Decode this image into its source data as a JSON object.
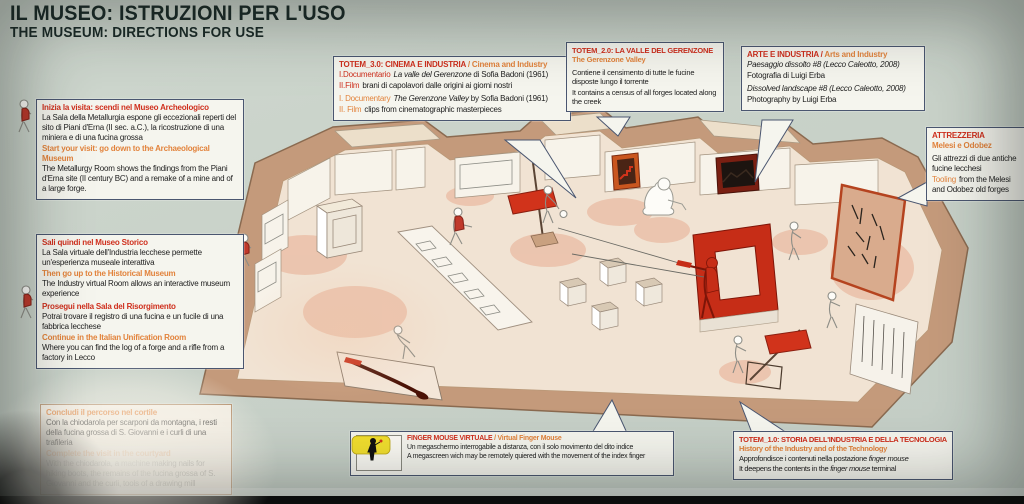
{
  "title": {
    "it": "IL MUSEO: ISTRUZIONI PER L'USO",
    "en": "THE MUSEUM: DIRECTIONS FOR USE"
  },
  "colors": {
    "accent_red": "#cf2f1d",
    "accent_orange": "#e2833c",
    "box_border": "#4a5670",
    "panel_background": "#c9d2c9",
    "room_wall": "#c9a180",
    "room_floor": "#f1e3d3",
    "highlight_salmon": "#e7ad92",
    "megascreen_red": "#c62d17",
    "finger_icon_yellow": "#f2df2e"
  },
  "boxes": {
    "archeo": {
      "h_it": "Inizia la visita: scendi nel Museo Archeologico",
      "b_it": "La Sala della Metallurgia espone gli eccezionali reperti del sito di Piani d'Erna (II sec. a.C.), la ricostruzione di una miniera e di una fucina grossa",
      "h_en": "Start your visit: go down to the Archaeological Museum",
      "b_en": "The Metallurgy Room shows the findings from the Piani d'Erna site (II century BC) and a remake of a mine and of a large forge."
    },
    "storico": {
      "h1_it": "Sali quindi nel Museo Storico",
      "b1_it": "La Sala virtuale dell'Industria lecchese permette un'esperienza museale interattiva",
      "h1_en": "Then go up to the Historical Museum",
      "b1_en": "The Industry virtual Room allows an interactive museum experience",
      "h2_it": "Prosegui nella Sala del Risorgimento",
      "b2_it": "Potrai trovare il registro di una fucina e un fucile di una fabbrica lecchese",
      "h2_en": "Continue in the Italian Unification Room",
      "b2_en": "Where you can find the log of a forge and a rifle from a factory in Lecco"
    },
    "cortile": {
      "h_it": "Concludi il percorso nel cortile",
      "b_it": "Con la chiodarola per scarponi da montagna, i resti della fucina grossa di S. Giovanni e i curli di una trafileria",
      "h_en": "Complete the visit in the courtyard",
      "b_en": "With the chiodarola, a machine making nails for hiking boots, the remains of the fucina grossa of S. Giovanni and the curli, tools of a drawing mill"
    },
    "totem3": {
      "h_it": "TOTEM_3.0: CINEMA E INDUSTRIA",
      "h_en": "/ Cinema and Industry",
      "l1_label": "I.Documentario",
      "l1_title": "La valle del Gerenzone",
      "l1_rest": "di Sofia Badoni (1961)",
      "l2_label": "II.Film",
      "l2_rest": "brani di capolavori dalle origini ai giorni nostri",
      "l3_label": "I. Documentary",
      "l3_title": "The Gerenzone Valley",
      "l3_rest": "by Sofia Badoni (1961)",
      "l4_label": "II. Film",
      "l4_rest": "clips from cinematographic masterpieces"
    },
    "totem2": {
      "h_it": "TOTEM_2.0: LA VALLE DEL GERENZONE",
      "h_en": "The Gerenzone Valley",
      "b_it": "Contiene il censimento di tutte le fucine disposte lungo il torrente",
      "b_en": "It contains a census of all forges located along the creek"
    },
    "arte": {
      "h_it": "ARTE E INDUSTRIA /",
      "h_en": "Arts and Industry",
      "work_it": "Paesaggio dissolto #8 (Lecco Caleotto, 2008)",
      "credit_it": "Fotografia di Luigi Erba",
      "work_en": "Dissolved landscape #8 (Lecco Caleotto, 2008)",
      "credit_en": "Photography by Luigi Erba"
    },
    "attrezzeria": {
      "h": "ATTREZZERIA",
      "sub": "Melesi e Odobez",
      "b_it": "Gli attrezzi di due antiche fucine lecchesi",
      "b_en_label": "Tooling",
      "b_en_rest": "from the Melesi and Odobez old forges"
    },
    "finger": {
      "h_it": "FINGER MOUSE VIRTUALE",
      "h_en": "/ Virtual Finger Mouse",
      "b_it": "Un megaschermo interrogabile a distanza, con il solo movimento del dito indice",
      "b_en": "A megascreen wich may be remotely quiered with the movement of the index finger"
    },
    "totem1": {
      "h_it": "TOTEM_1.0: STORIA DELL'INDUSTRIA E DELLA TECNOLOGIA",
      "h_en": "History of the Industry and of the Technology",
      "b_it_pre": "Approfondisce i contenuti nella postazione",
      "b_it_em": "finger mouse",
      "b_en_pre": "It deepens the contents in the",
      "b_en_em": "finger mouse",
      "b_en_post": "terminal"
    }
  }
}
